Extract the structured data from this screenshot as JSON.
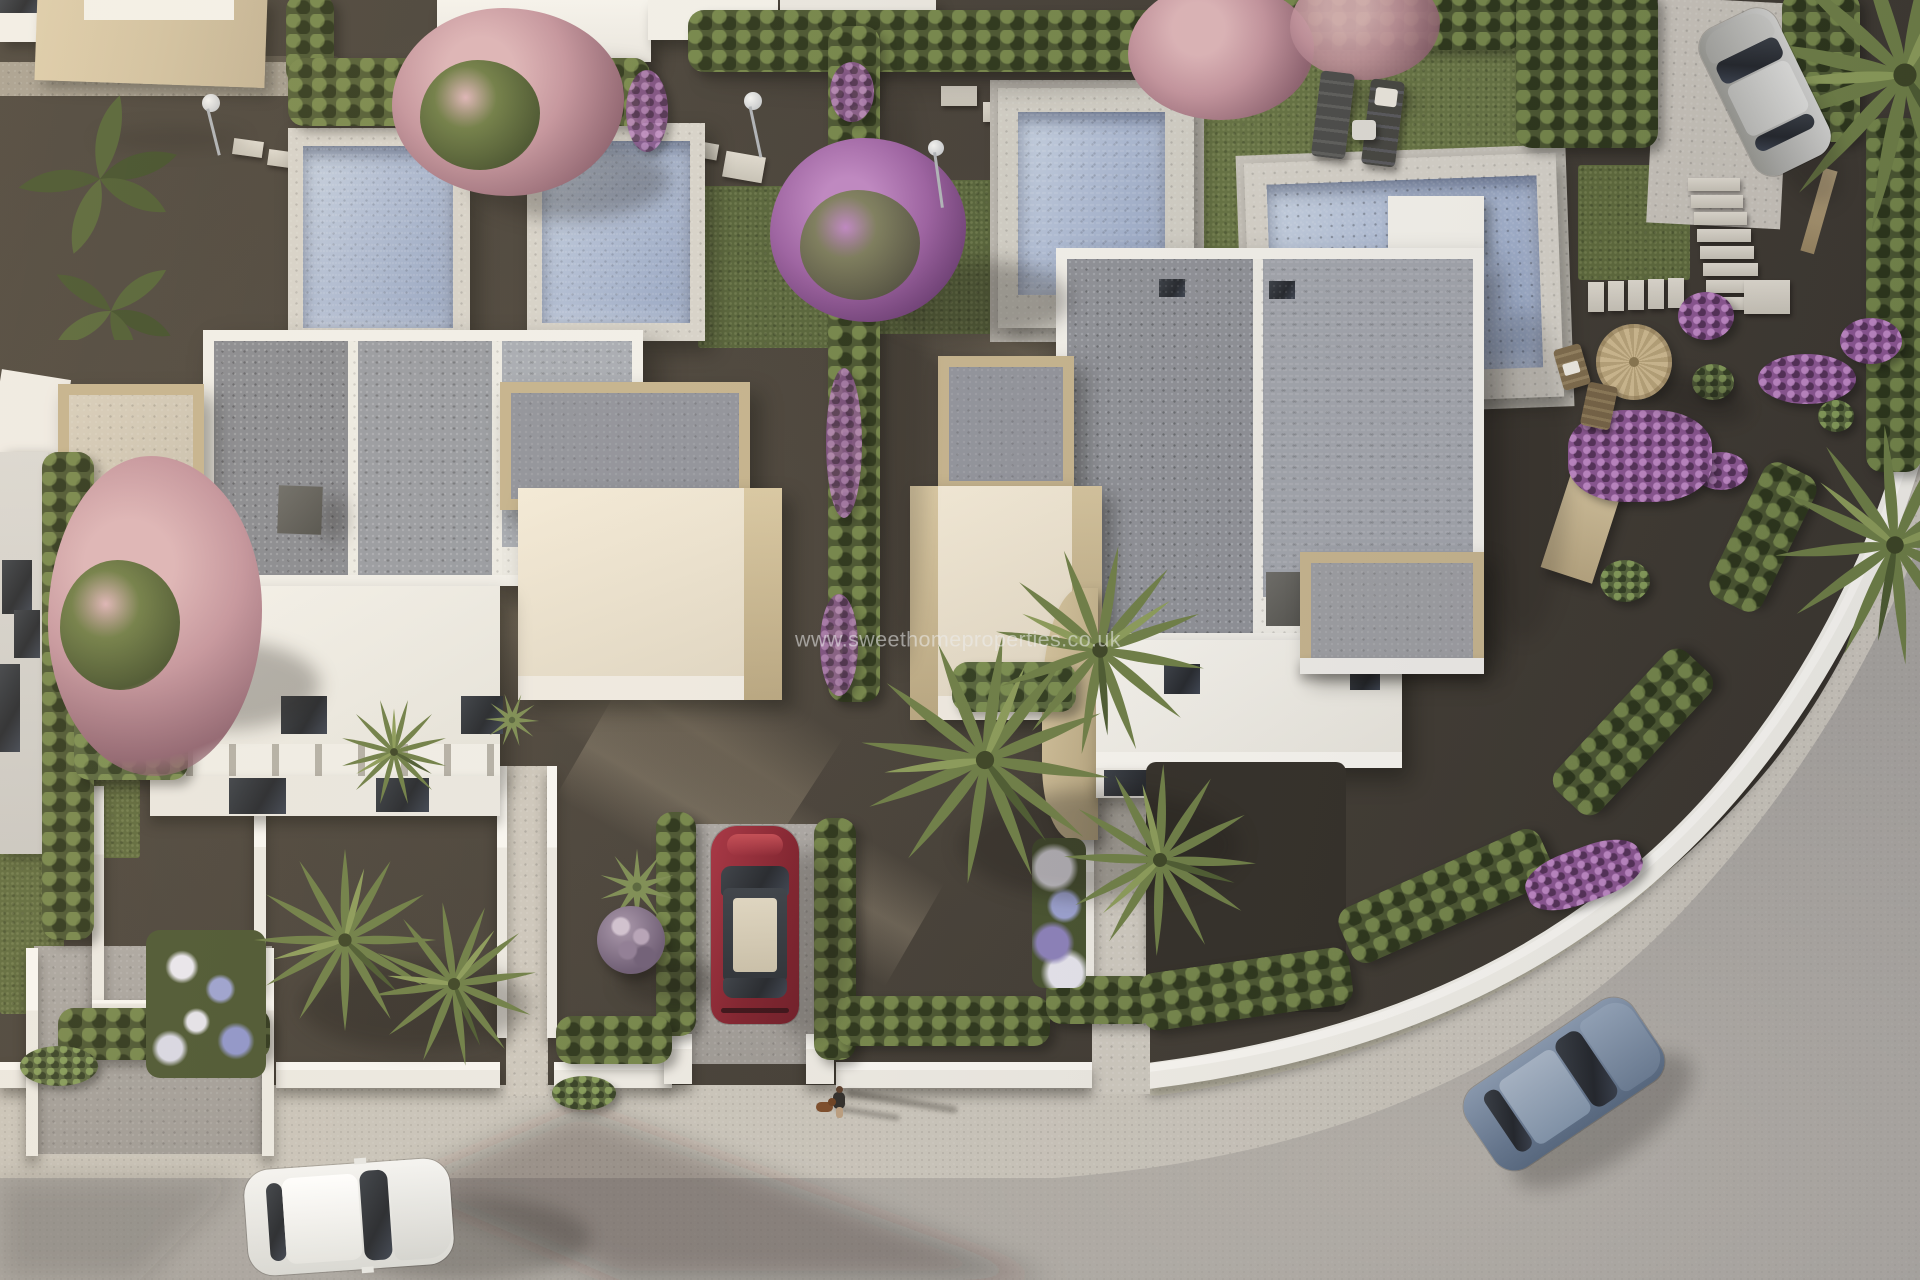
{
  "watermark": {
    "text": "www.sweethomeproperties.co.uk"
  },
  "scene": {
    "type": "aerial-3d-architectural-render",
    "description": "Bird's-eye dusk view of a modern white villa development with private pools, gravel gardens, palms and a curving street",
    "inventory": {
      "villas": [
        "left-villa",
        "right-villa"
      ],
      "neighbor_buildings": 5,
      "pools": 4,
      "cars": [
        {
          "name": "white-car",
          "location": "road-bottom-left"
        },
        {
          "name": "red-car",
          "location": "center-driveway"
        },
        {
          "name": "blue-car",
          "location": "road-bottom-right-curve"
        },
        {
          "name": "silver-car",
          "location": "driveway-top-right"
        }
      ],
      "person_walking_dog": 1,
      "sun_loungers": 2,
      "straw_parasol": 1,
      "deck_chairs": 2,
      "outdoor_showers": 3,
      "stepping_stone_paths": 4,
      "flowering_trees": [
        "pink-tree-top-left",
        "pink-tree-top-right",
        "pink-tree-mid-left",
        "purple-tree-center"
      ],
      "palm_trees": 8
    }
  },
  "palette": {
    "gravel": "#433d35",
    "road": "#a7a39e",
    "sidewalk": "#c8c3b9",
    "wallWhite": "#efede6",
    "roofGravel": "#92949a",
    "stone": "#c4b28c",
    "stoneLight": "#dccba4",
    "poolWater": "#a3b2cc",
    "coping": "#d6d2c9",
    "lawn": "#5c683a",
    "hedge": "#49542f",
    "hedgeLight": "#6d7b44",
    "blossomPink": "#c3939c",
    "blossomPurple": "#9a5f9f",
    "cream": "#e3dac6",
    "carRed": "#8c2331",
    "carBlue": "#72839a",
    "carSilver": "#b7b6b2",
    "carWhite": "#e9e9e7"
  }
}
